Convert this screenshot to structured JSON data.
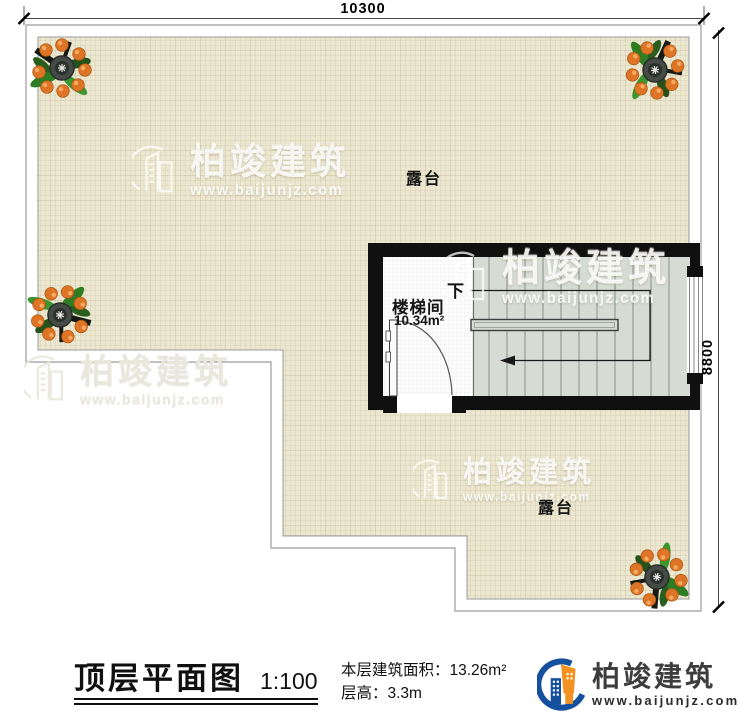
{
  "plan": {
    "dimension_top": "10300",
    "dimension_right": "8800",
    "terrace_label_upper": "露台",
    "terrace_label_lower": "露台",
    "stair_room_label": "楼梯间",
    "stair_room_area": "10.34m²",
    "stair_down_label": "下"
  },
  "title_block": {
    "title": "顶层平面图",
    "scale": "1:100",
    "floor_area": "本层建筑面积：13.26m²",
    "floor_height": "层高：3.3m"
  },
  "watermark": {
    "brand": "柏竣建筑",
    "site": "www.baijunjz.com"
  },
  "brand_logo": {
    "name": "柏竣建筑",
    "site": "www.baijunjz.com"
  },
  "colors": {
    "wall_black": "#101010",
    "terrace_fill": "#ece7d1",
    "terrace_grid": "#d9d1b2",
    "stair_fill": "#d6dcd4",
    "logo_blue": "#15509e",
    "logo_orange": "#f29222"
  }
}
